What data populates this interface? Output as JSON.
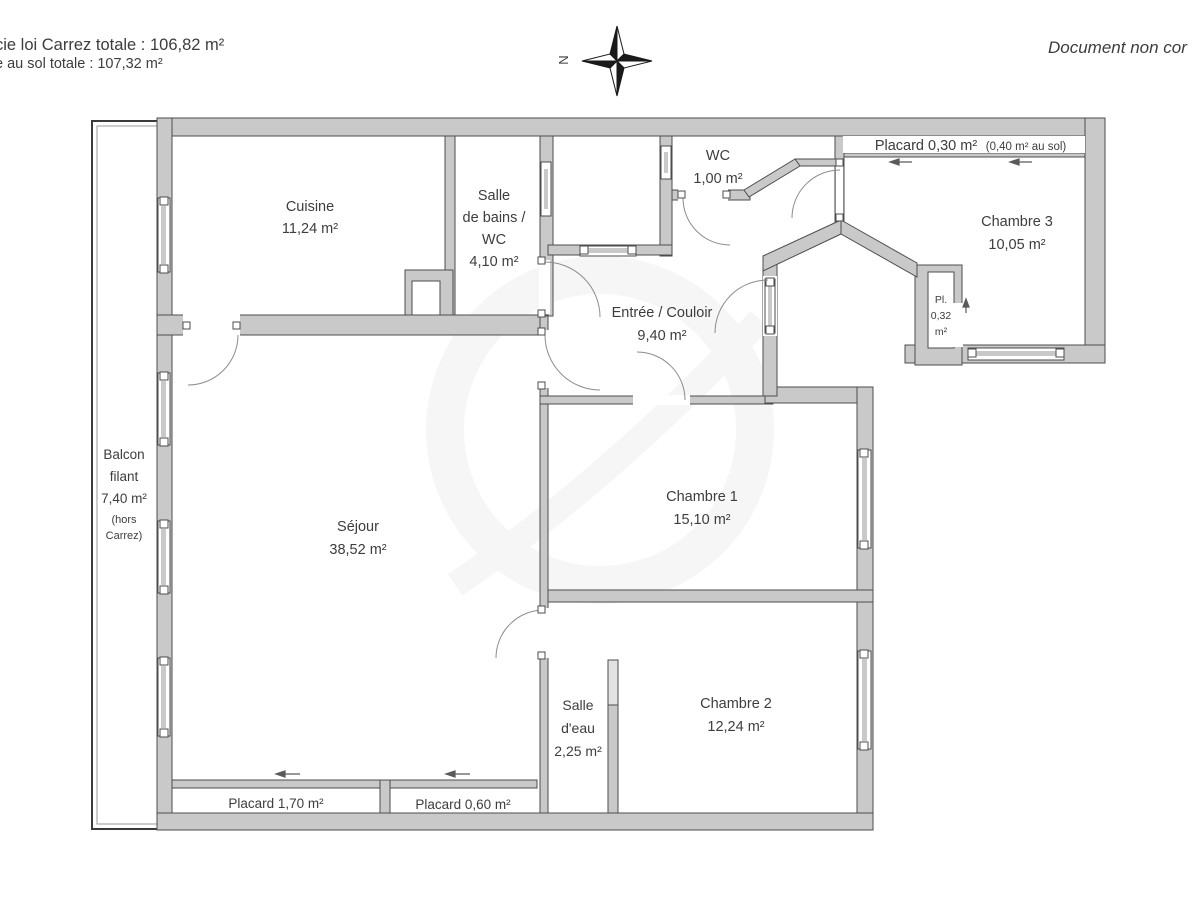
{
  "header": {
    "line1": "cie loi Carrez totale :  106,82 m²",
    "line2": "e au sol totale :  107,32 m²",
    "right_note": "Document non cor",
    "compass_n": "N"
  },
  "rooms": {
    "cuisine": {
      "name": "Cuisine",
      "area": "11,24 m²"
    },
    "salle_de_bains": {
      "line1": "Salle",
      "line2": "de bains /",
      "line3": "WC",
      "area": "4,10 m²"
    },
    "wc": {
      "name": "WC",
      "area": "1,00 m²"
    },
    "placard_haut": {
      "name": "Placard 0,30 m²",
      "note": "(0,40 m² au sol)"
    },
    "chambre3": {
      "name": "Chambre 3",
      "area": "10,05 m²"
    },
    "pl_closet": {
      "line1": "Pl.",
      "line2": "0,32",
      "line3": "m²"
    },
    "entree": {
      "name": "Entrée / Couloir",
      "area": "9,40 m²"
    },
    "balcon": {
      "line1": "Balcon",
      "line2": "filant",
      "line3": "7,40 m²",
      "line4": "(hors",
      "line5": "Carrez)"
    },
    "sejour": {
      "name": "Séjour",
      "area": "38,52 m²"
    },
    "chambre1": {
      "name": "Chambre 1",
      "area": "15,10 m²"
    },
    "chambre2": {
      "name": "Chambre 2",
      "area": "12,24 m²"
    },
    "salle_eau": {
      "line1": "Salle",
      "line2": "d'eau",
      "area": "2,25 m²"
    },
    "placard_bas1": {
      "name": "Placard 1,70 m²"
    },
    "placard_bas2": {
      "name": "Placard 0,60 m²"
    }
  },
  "colors": {
    "wall_fill": "#c9c9c9",
    "wall_edge": "#4d4d4d",
    "text": "#3d3d3d",
    "compass_black": "#1a1a1a"
  }
}
